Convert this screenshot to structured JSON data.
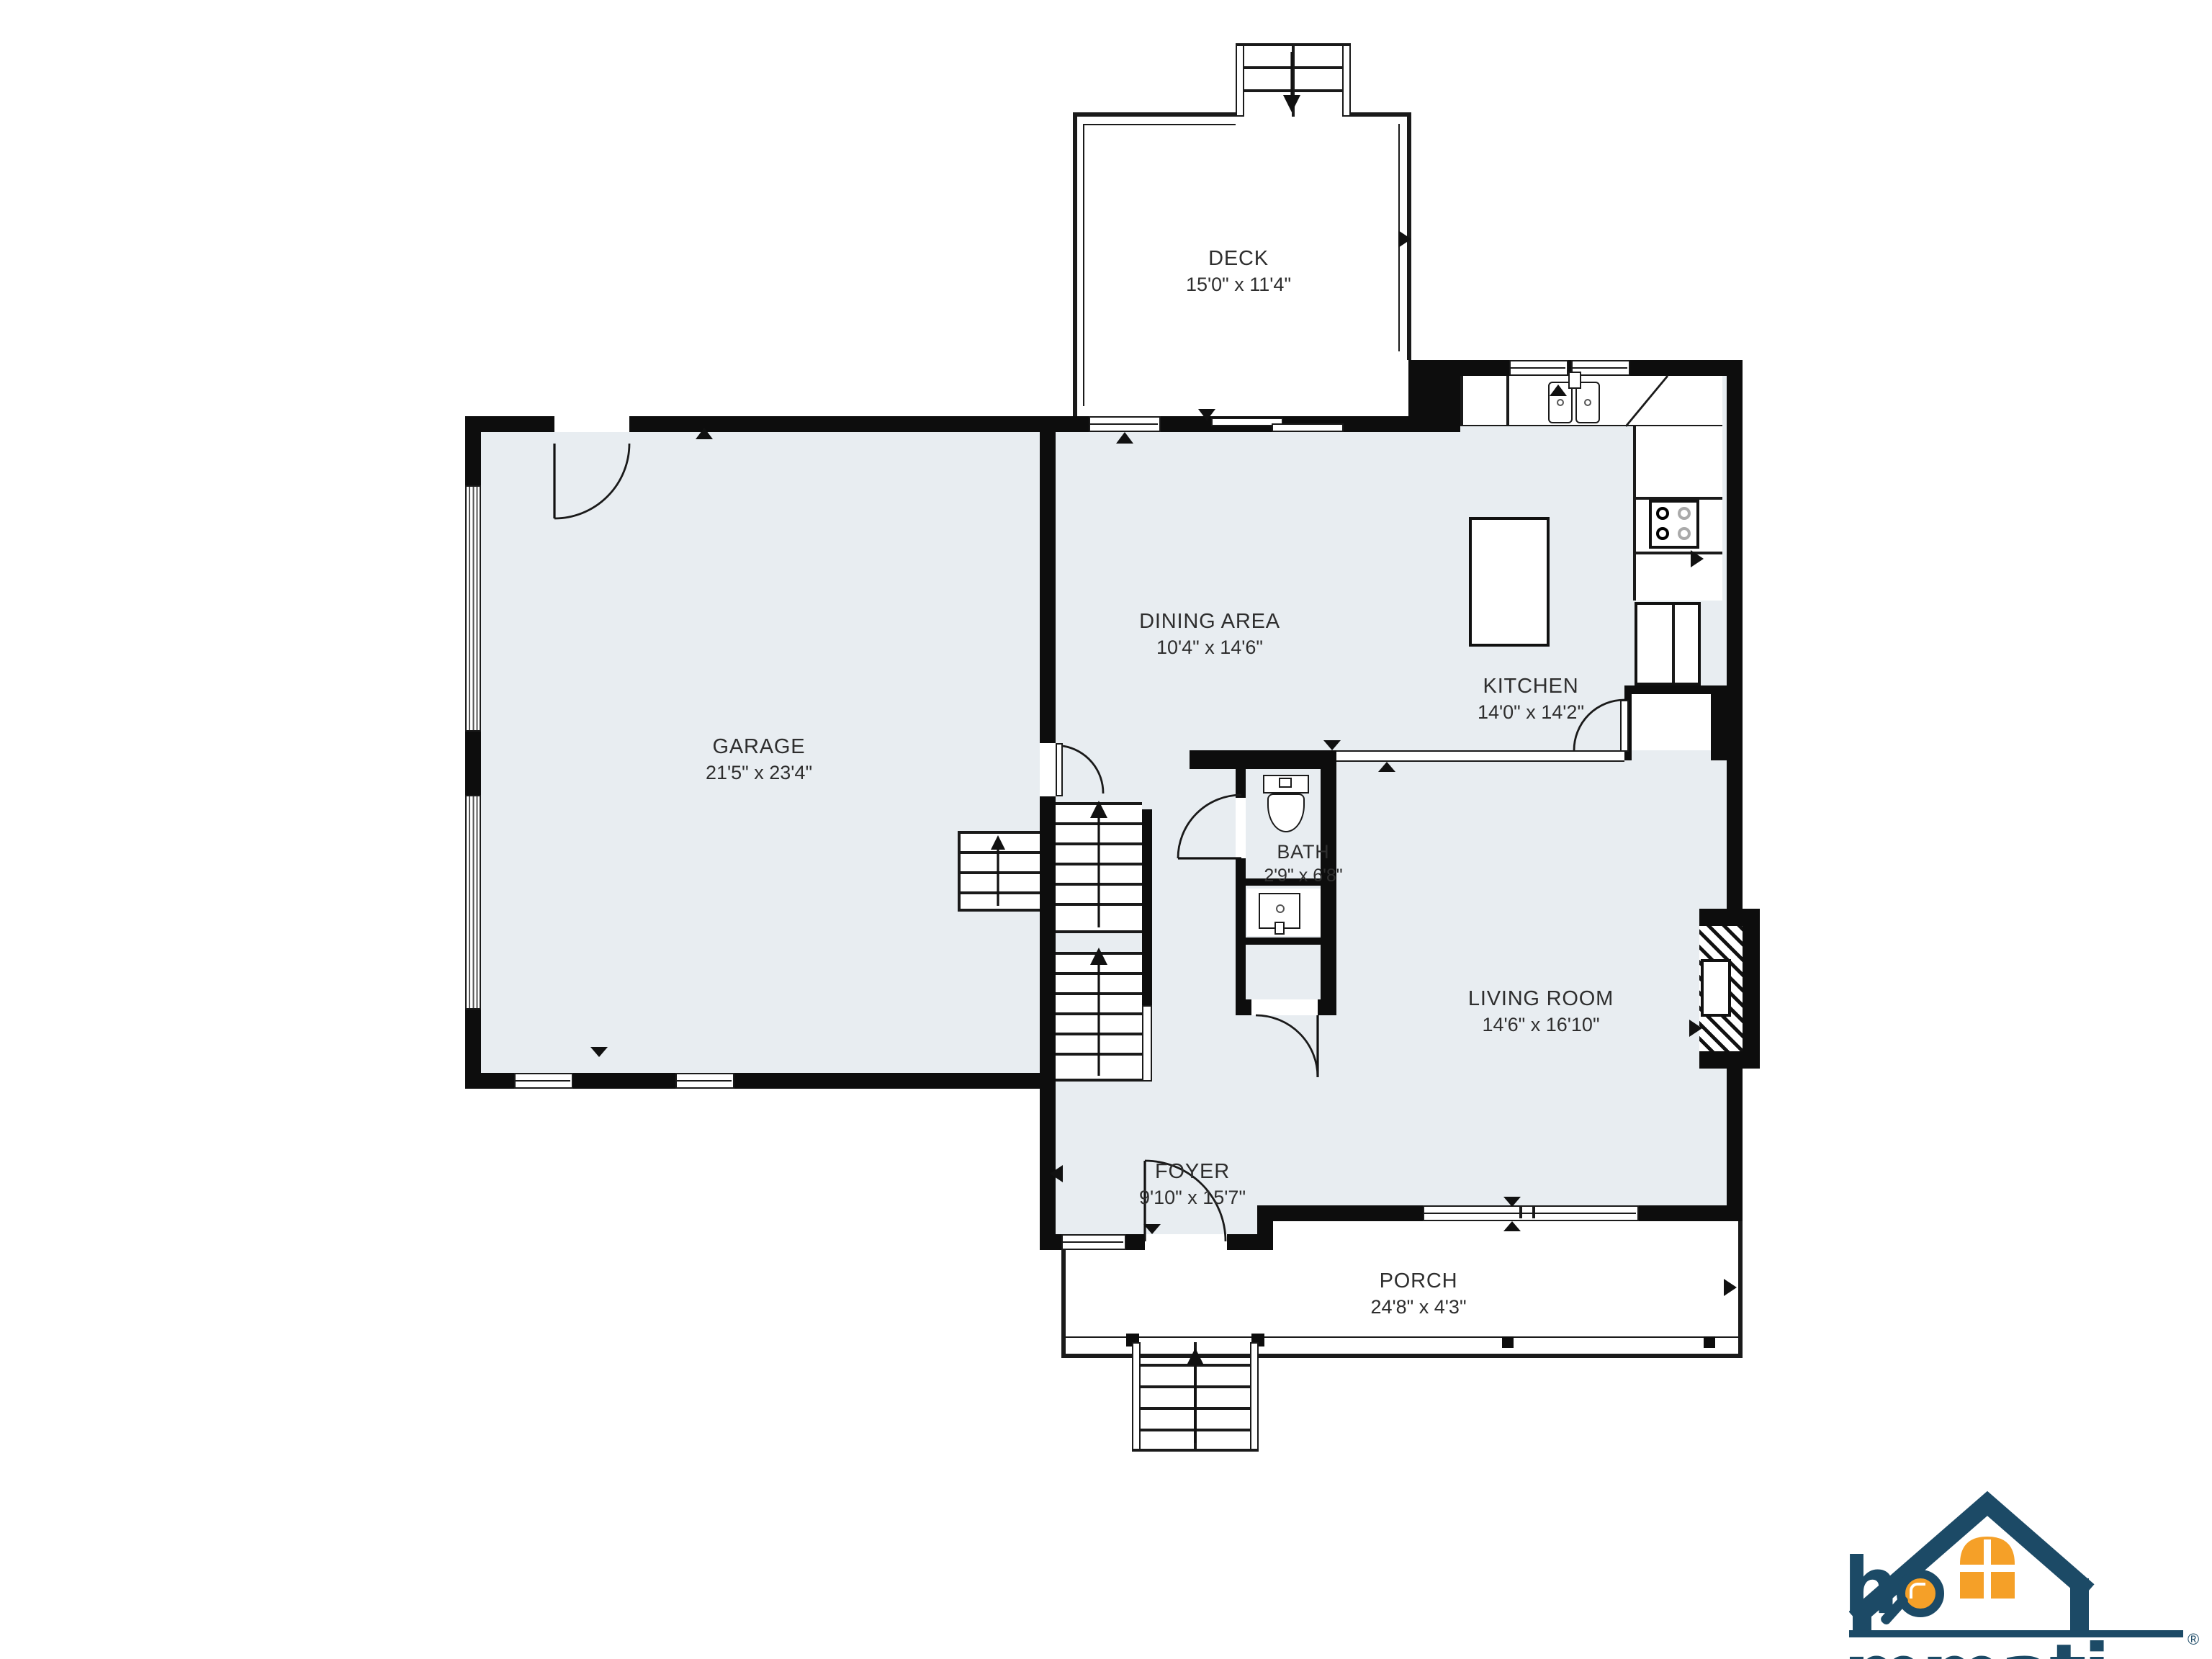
{
  "floor_plan": {
    "rooms": {
      "deck": {
        "name": "DECK",
        "dims": "15'0\" x 11'4\""
      },
      "garage": {
        "name": "GARAGE",
        "dims": "21'5\" x 23'4\""
      },
      "dining": {
        "name": "DINING AREA",
        "dims": "10'4\" x 14'6\""
      },
      "kitchen": {
        "name": "KITCHEN",
        "dims": "14'0\" x 14'2\""
      },
      "bath": {
        "name": "BATH",
        "dims": "2'9\" x 6'8\""
      },
      "living": {
        "name": "LIVING ROOM",
        "dims": "14'6\" x 16'10\""
      },
      "foyer": {
        "name": "FOYER",
        "dims": "9'10\" x 15'7\""
      },
      "porch": {
        "name": "PORCH",
        "dims": "24'8\" x 4'3\""
      }
    },
    "colors": {
      "wall": "#0d0d0d",
      "room_fill": "#e8edf1",
      "line": "#1a1a1a"
    }
  },
  "branding": {
    "logo_prefix": "h",
    "logo_suffix": "mmati",
    "registered_mark": "®",
    "navy": "#1c4a66",
    "orange": "#f5a028"
  }
}
